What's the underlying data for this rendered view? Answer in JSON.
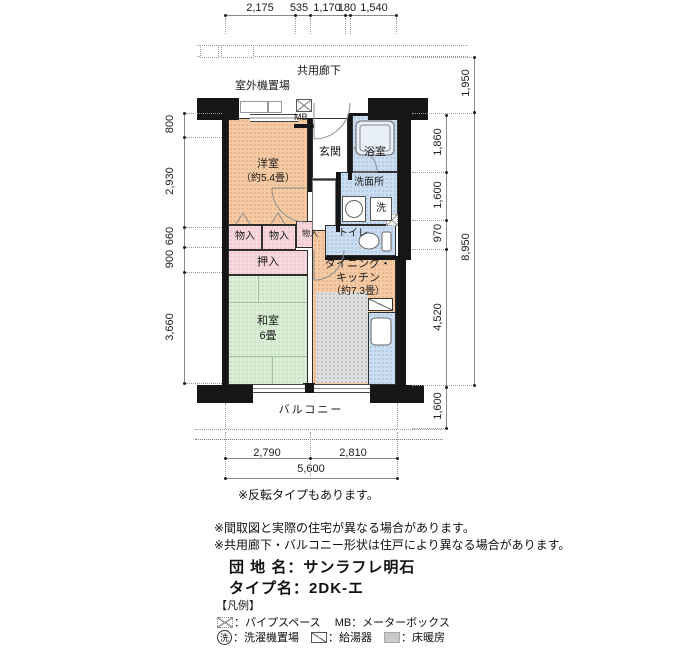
{
  "plan": {
    "corridor_label": "共用廊下",
    "outdoor_unit_label": "室外機置場",
    "mb_label": "MB",
    "entrance": "玄関",
    "bathroom": "浴室",
    "washroom": "洗面所",
    "washer": "洗",
    "toilet": "トイレ",
    "western_room_l1": "洋室",
    "western_room_l2": "（約5.4畳）",
    "storage": "物入",
    "closet": "押入",
    "japanese_room_l1": "和室",
    "japanese_room_l2": "6畳",
    "dk_l1": "ダイニング・",
    "dk_l2": "キッチン",
    "dk_l3": "（約7.3畳）",
    "balcony": "バルコニー"
  },
  "dims": {
    "top": [
      "2,175",
      "535",
      "1,170",
      "180",
      "1,540"
    ],
    "left": [
      "800",
      "2,930",
      "660",
      "900",
      "3,660"
    ],
    "right_inner": [
      "1,860",
      "1,600",
      "970",
      "4,520",
      "1,600"
    ],
    "right_outer": [
      "1,950",
      "8,950"
    ],
    "bottom": [
      "2,790",
      "2,810"
    ],
    "bottom_total": "5,600"
  },
  "notes": {
    "reverse": "※反転タイプもあります。",
    "line1": "※間取図と実際の住宅が異なる場合があります。",
    "line2": "※共用廊下・バルコニー形状は住戸により異なる場合があります。"
  },
  "property": {
    "estate_label": "団 地 名：",
    "estate_value": "サンラフレ明石",
    "type_label": "タイプ名：",
    "type_value": "2DK-エ"
  },
  "legend": {
    "heading": "【凡例】",
    "pipe_space": "：パイプスペース",
    "meter_box": "MB：メーターボックス",
    "washer_symbol": "洗",
    "washer_space": "：洗濯機置場",
    "water_heater": "：給湯器",
    "floor_heating": "：床暖房"
  },
  "colors": {
    "room_peach": "#f5caa4",
    "closet_pink": "#f8d8de",
    "tatami_green": "#dbeed6",
    "wet_blue": "#cbdef1",
    "floor_heating_gray": "#dedede",
    "wall_black": "#161616"
  }
}
